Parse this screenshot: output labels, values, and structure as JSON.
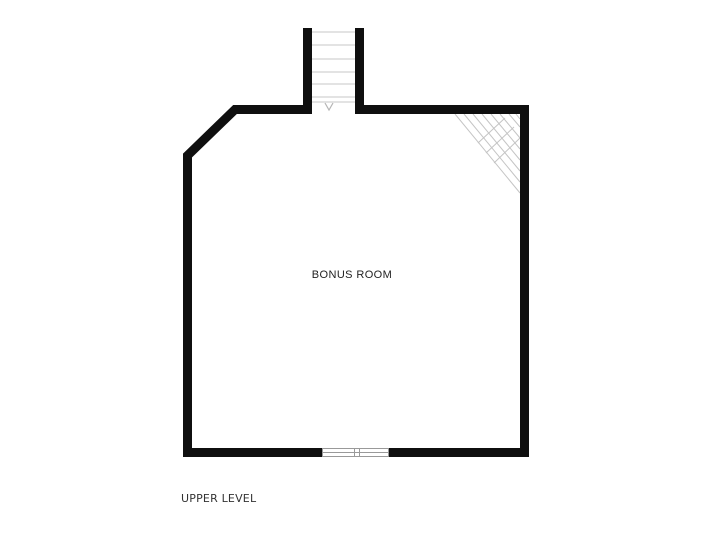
{
  "canvas": {
    "width": 719,
    "height": 540,
    "background": "#ffffff"
  },
  "plan": {
    "room_label": "BONUS ROOM",
    "level_label": "UPPER LEVEL",
    "stair_direction_marker": "v",
    "features": {
      "staircase": "top-center",
      "window": "bottom-center",
      "sloped_ceiling_hatch": "top-right-corner",
      "angled_wall": "top-left-corner"
    },
    "colors": {
      "wall": "#0f0f0f",
      "tread_line": "#d2d2d2",
      "hatch_line": "#c4c4c4",
      "window_line": "#999999",
      "arrow_line": "#b5b5b5",
      "room_label": "#222222",
      "level_label": "#333333"
    }
  }
}
